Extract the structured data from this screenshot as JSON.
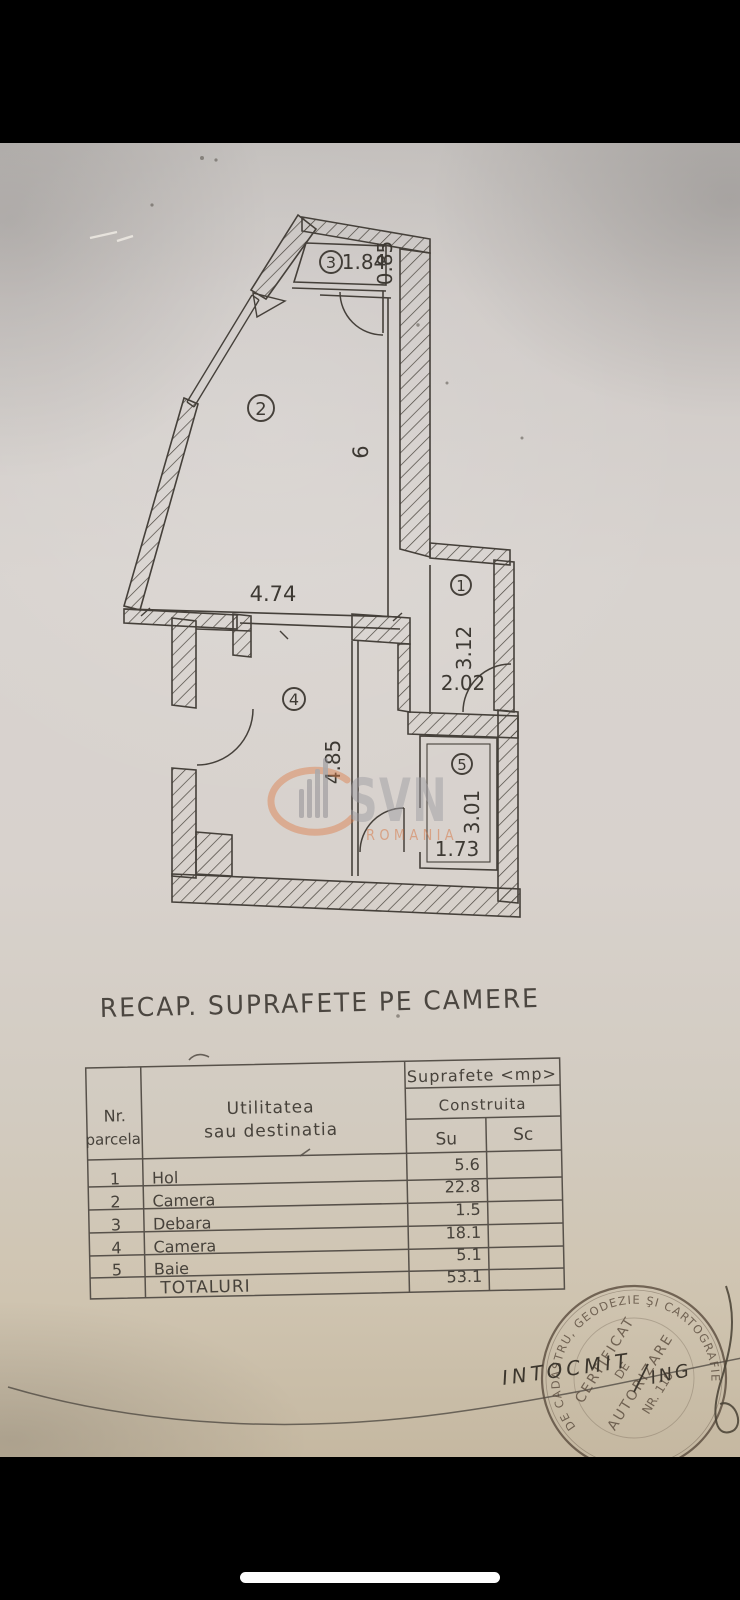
{
  "title": "RECAP. SUPRAFETE PE CAMERE",
  "plan": {
    "rooms": [
      {
        "num": "1"
      },
      {
        "num": "2"
      },
      {
        "num": "3"
      },
      {
        "num": "4"
      },
      {
        "num": "5"
      }
    ],
    "dims": [
      {
        "text": "1.84"
      },
      {
        "text": "0.85"
      },
      {
        "text": "6"
      },
      {
        "text": "4.74"
      },
      {
        "text": "3.12"
      },
      {
        "text": "2.02"
      },
      {
        "text": "4.85"
      },
      {
        "text": "3.01"
      },
      {
        "text": "1.73"
      }
    ]
  },
  "watermark": {
    "brand": "SVN",
    "country": "ROMANIA"
  },
  "table": {
    "header": {
      "nr1": "Nr.",
      "nr2": "parcela",
      "util1": "Utilitatea",
      "util2": "sau destinatia",
      "suprafete": "Suprafete <mp>",
      "construita": "Construita",
      "su": "Su",
      "sc": "Sc"
    },
    "rows": [
      {
        "nr": "1",
        "name": "Hol",
        "su": "5.6",
        "sc": ""
      },
      {
        "nr": "2",
        "name": "Camera",
        "su": "22.8",
        "sc": ""
      },
      {
        "nr": "3",
        "name": "Debara",
        "su": "1.5",
        "sc": ""
      },
      {
        "nr": "4",
        "name": "Camera",
        "su": "18.1",
        "sc": ""
      },
      {
        "nr": "5",
        "name": "Baie",
        "su": "5.1",
        "sc": ""
      }
    ],
    "total": {
      "label": "TOTALURI",
      "su": "53.1"
    }
  },
  "stamp": {
    "rim": "DE CADASTRU, GEODEZIE ŞI CARTOGRAFIE",
    "line1": "CERTIFICAT",
    "line2": "DE",
    "line3": "AUTORIZARE",
    "line4": "NR. 110"
  },
  "annotations": {
    "intocmit": "INTOCMIT",
    "ing": "ING"
  },
  "colors": {
    "paper": "#d6d1cd",
    "ink": "#44403a",
    "stamp_ink": "#57483a",
    "watermark_grey": "#9d9ca2",
    "watermark_orange": "#d5713c",
    "home_indicator": "#fdfdfd"
  }
}
